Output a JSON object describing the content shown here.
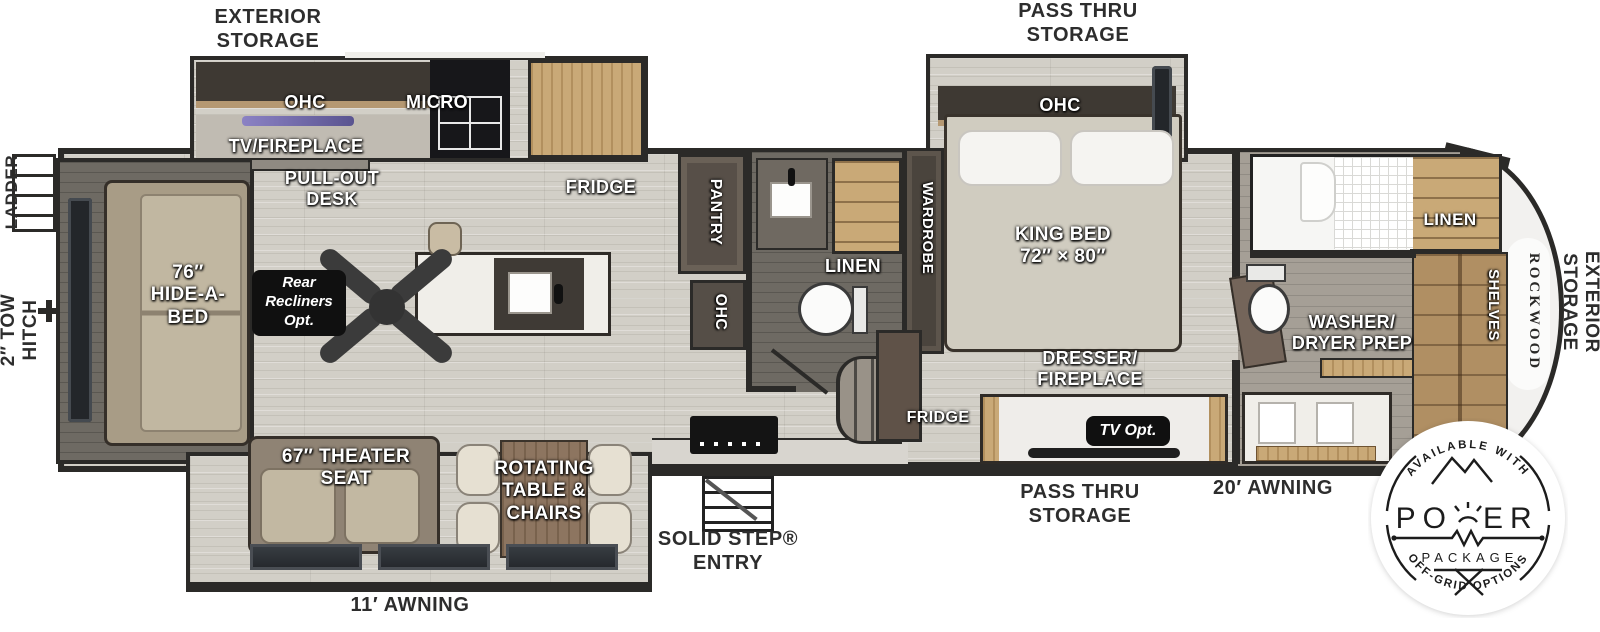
{
  "exterior": {
    "storage_rear": "EXTERIOR\nSTORAGE",
    "pass_thru_top": "PASS THRU\nSTORAGE",
    "ladder": "LADDER",
    "tow_hitch": "2″ TOW\nHITCH",
    "awning_living": "11′ AWNING",
    "solid_step": "SOLID STEP®\nENTRY",
    "pass_thru_bottom": "PASS THRU\nSTORAGE",
    "awning_front": "20′ AWNING",
    "storage_front": "EXTERIOR\nSTORAGE"
  },
  "living": {
    "hide_a_bed": "76″\nHIDE-A-\nBED",
    "rear_recliners": "Rear\nRecliners\nOpt.",
    "ohc": "OHC",
    "micro": "MICRO",
    "tv_fireplace": "TV/FIREPLACE",
    "pull_out_desk": "PULL-OUT\nDESK",
    "fridge": "FRIDGE",
    "theater_seat": "67″ THEATER\nSEAT",
    "rotating_table": "ROTATING\nTABLE &\nCHAIRS"
  },
  "bath_mid": {
    "pantry": "PANTRY",
    "ohc": "OHC",
    "linen": "LINEN"
  },
  "bedroom": {
    "wardrobe": "WARDROBE",
    "ohc": "OHC",
    "king_bed": "KING BED\n72″ × 80″",
    "dresser": "DRESSER/\nFIREPLACE",
    "fridge": "FRIDGE",
    "tv_opt": "TV Opt."
  },
  "bath_front": {
    "washer_dryer": "WASHER/\nDRYER PREP",
    "linen": "LINEN",
    "shelves": "SHELVES"
  },
  "brand": {
    "name": "ROCKWOOD"
  },
  "badge": {
    "top_text": "AVAILABLE WITH",
    "word_left": "PO",
    "word_right": "ER",
    "package": "PACKAGE",
    "bottom_text": "OFF-GRID OPTIONS"
  },
  "colors": {
    "wall": "#2b2a28",
    "floor": "#d2cfc7",
    "floor_bath": "#6e6a63",
    "wood": "#c9a977",
    "sofa": "#b5a994",
    "counter": "#f0eee9",
    "appliance": "#141414",
    "tv_accent": "#7a6fb5",
    "label_white": "#ffffff",
    "label_dark": "#2d2d2d"
  }
}
